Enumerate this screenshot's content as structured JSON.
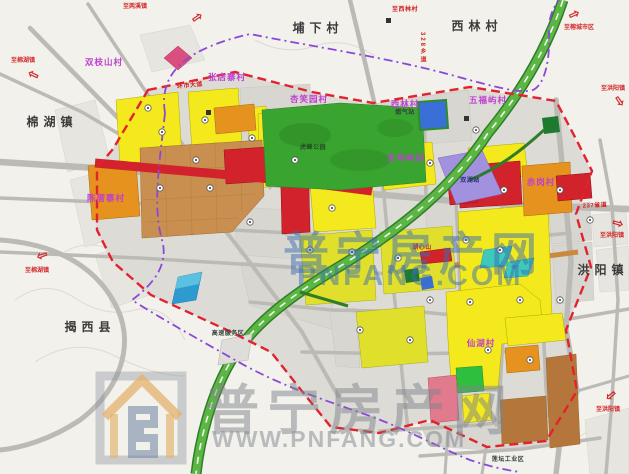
{
  "map": {
    "towns": [
      {
        "text": "埔下村",
        "x": 318,
        "y": 28
      },
      {
        "text": "西林村",
        "x": 477,
        "y": 26
      },
      {
        "text": "棉湖镇",
        "x": 52,
        "y": 122
      },
      {
        "text": "揭西县",
        "x": 90,
        "y": 327
      },
      {
        "text": "洪阳镇",
        "x": 603,
        "y": 270
      }
    ],
    "villages": [
      {
        "text": "双枝山村",
        "x": 104,
        "y": 62
      },
      {
        "text": "张店寨村",
        "x": 227,
        "y": 77
      },
      {
        "text": "杏笑园村",
        "x": 309,
        "y": 99
      },
      {
        "text": "西林村",
        "x": 405,
        "y": 104
      },
      {
        "text": "五福屿村",
        "x": 488,
        "y": 100
      },
      {
        "text": "东华屿村",
        "x": 406,
        "y": 158
      },
      {
        "text": "陈厝寨村",
        "x": 106,
        "y": 198
      },
      {
        "text": "仙湖村",
        "x": 481,
        "y": 343
      },
      {
        "text": "赤岗村",
        "x": 541,
        "y": 182
      }
    ],
    "road_names": [
      {
        "text": "至西林村",
        "x": 405,
        "y": 10
      },
      {
        "text": "328乡道",
        "x": 422,
        "y": 48,
        "vert": true
      },
      {
        "text": "237省道",
        "x": 595,
        "y": 206,
        "rot": -3
      },
      {
        "text": "环市大道",
        "x": 190,
        "y": 86,
        "rot": -6
      },
      {
        "text": "湖心山",
        "x": 422,
        "y": 248
      }
    ],
    "sites": [
      {
        "text": "虎峰公园",
        "x": 313,
        "y": 148,
        "color": "#234d23"
      },
      {
        "text": "双湖站",
        "x": 470,
        "y": 181,
        "color": "#26306b"
      },
      {
        "text": "燃气站",
        "x": 405,
        "y": 113
      },
      {
        "text": "高速服务区",
        "x": 228,
        "y": 334
      },
      {
        "text": "莲坛工业区",
        "x": 508,
        "y": 460
      }
    ],
    "arrows": [
      {
        "label": "至两溪镇",
        "lx": 135,
        "ly": 7,
        "ax": 197,
        "ay": 17,
        "rot": -35
      },
      {
        "label": "至棉湖镇",
        "lx": 23,
        "ly": 61,
        "ax": 33,
        "ay": 75,
        "rot": 205
      },
      {
        "label": "至棉湖镇",
        "lx": 37,
        "ly": 271,
        "ax": 42,
        "ay": 256,
        "rot": 160
      },
      {
        "label": "至榕城市区",
        "lx": 579,
        "ly": 28,
        "ax": 574,
        "ay": 14,
        "rot": -25
      },
      {
        "label": "至洪阳镇",
        "lx": 613,
        "ly": 89,
        "ax": 620,
        "ay": 101,
        "rot": 55
      },
      {
        "label": "至洪阳镇",
        "lx": 612,
        "ly": 236,
        "ax": 618,
        "ay": 223,
        "rot": 15
      },
      {
        "label": "至洪阳镇",
        "lx": 608,
        "ly": 410,
        "ax": 611,
        "ay": 396,
        "rot": 140
      }
    ]
  },
  "watermarks": {
    "center": {
      "line1": "普宁房产网",
      "line2": "PNFANG.COM"
    },
    "bottom": {
      "line1": "普宁房产网",
      "line2": "WWW.PNFANG.COM"
    }
  },
  "colors": {
    "residential_yellow": "#f3e91c",
    "mixed_yellow_green": "#e0e02c",
    "commercial_red": "#d2232d",
    "village_orange": "#e6921e",
    "industrial_tan": "#c98f50",
    "park_green": "#3aa430",
    "highway_green": "#5cb644",
    "station_purple": "#a191de",
    "water_blue": "#2e9bd0",
    "boundary_red": "#e2232e",
    "boundary_purple": "#8b48d8",
    "village_label_purple": "#bf3fd0",
    "watermark_blue": "rgba(58,110,175,0.5)",
    "watermark_gray": "rgba(125,131,138,0.5)",
    "watermark_gray2": "rgba(135,142,150,0.55)"
  }
}
